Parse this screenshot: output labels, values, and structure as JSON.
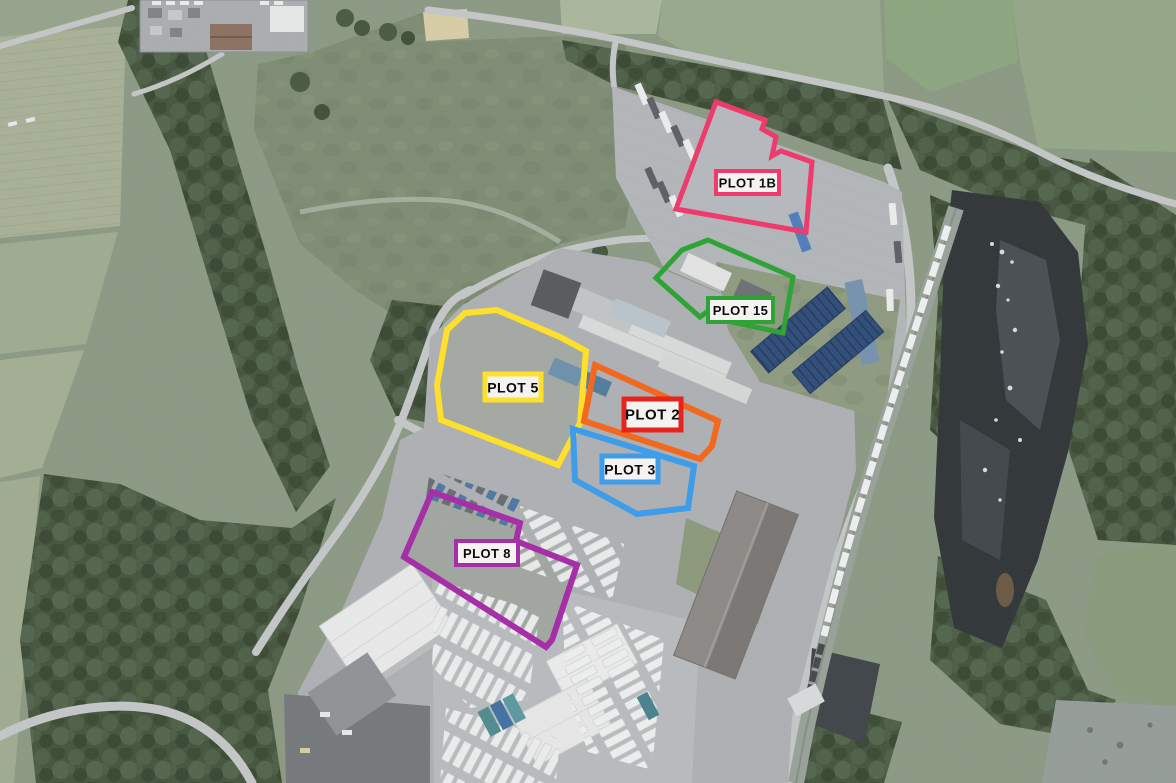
{
  "map": {
    "kind": "aerial-site-plan",
    "label_text_color": "#0b0b0b",
    "label_bg": "#f5f3f2",
    "plots": [
      {
        "id": "1b",
        "label": "PLOT 1B",
        "color": "#ee3a6c",
        "outline_w": 5,
        "points": "716,102 765,120 762,129 776,137 772,156 781,151 812,162 806,232 676,209",
        "label_box": {
          "x": 716,
          "y": 171,
          "w": 63,
          "h": 23
        },
        "label_border": "#ee3a6c",
        "border_w": 4,
        "font_size": 13
      },
      {
        "id": "15",
        "label": "PLOT 15",
        "color": "#2fa336",
        "outline_w": 5,
        "points": "708,240 793,277 783,333 718,319 712,308 700,317 656,278 682,250",
        "label_box": {
          "x": 708,
          "y": 298,
          "w": 65,
          "h": 24
        },
        "label_border": "#2fa336",
        "border_w": 4,
        "font_size": 13
      },
      {
        "id": "5",
        "label": "PLOT 5",
        "color": "#fee02c",
        "outline_w": 6,
        "points": "465,313 497,310 560,337 586,351 580,423 558,465 441,420 437,385 447,330",
        "label_box": {
          "x": 485,
          "y": 374,
          "w": 56,
          "h": 26
        },
        "label_border": "#fee02c",
        "border_w": 5,
        "font_size": 14
      },
      {
        "id": "2",
        "label": "PLOT 2",
        "color": "#f2681f",
        "outline_w": 6,
        "points": "595,365 718,421 712,446 700,459 584,421",
        "label_box": {
          "x": 624,
          "y": 399,
          "w": 57,
          "h": 31
        },
        "label_border": "#e8231c",
        "border_w": 5,
        "font_size": 15
      },
      {
        "id": "3",
        "label": "PLOT 3",
        "color": "#3f9ce8",
        "outline_w": 6,
        "points": "573,429 694,466 688,508 637,514 575,480",
        "label_box": {
          "x": 602,
          "y": 456,
          "w": 56,
          "h": 26
        },
        "label_border": "#3f9ce8",
        "border_w": 5,
        "font_size": 14
      },
      {
        "id": "8",
        "label": "PLOT 8",
        "color": "#a62fa8",
        "outline_w": 6,
        "points": "432,492 520,523 516,541 577,565 552,640 546,647 404,557",
        "label_box": {
          "x": 456,
          "y": 541,
          "w": 62,
          "h": 24
        },
        "label_border": "#a62fa8",
        "border_w": 4,
        "font_size": 13
      }
    ]
  }
}
